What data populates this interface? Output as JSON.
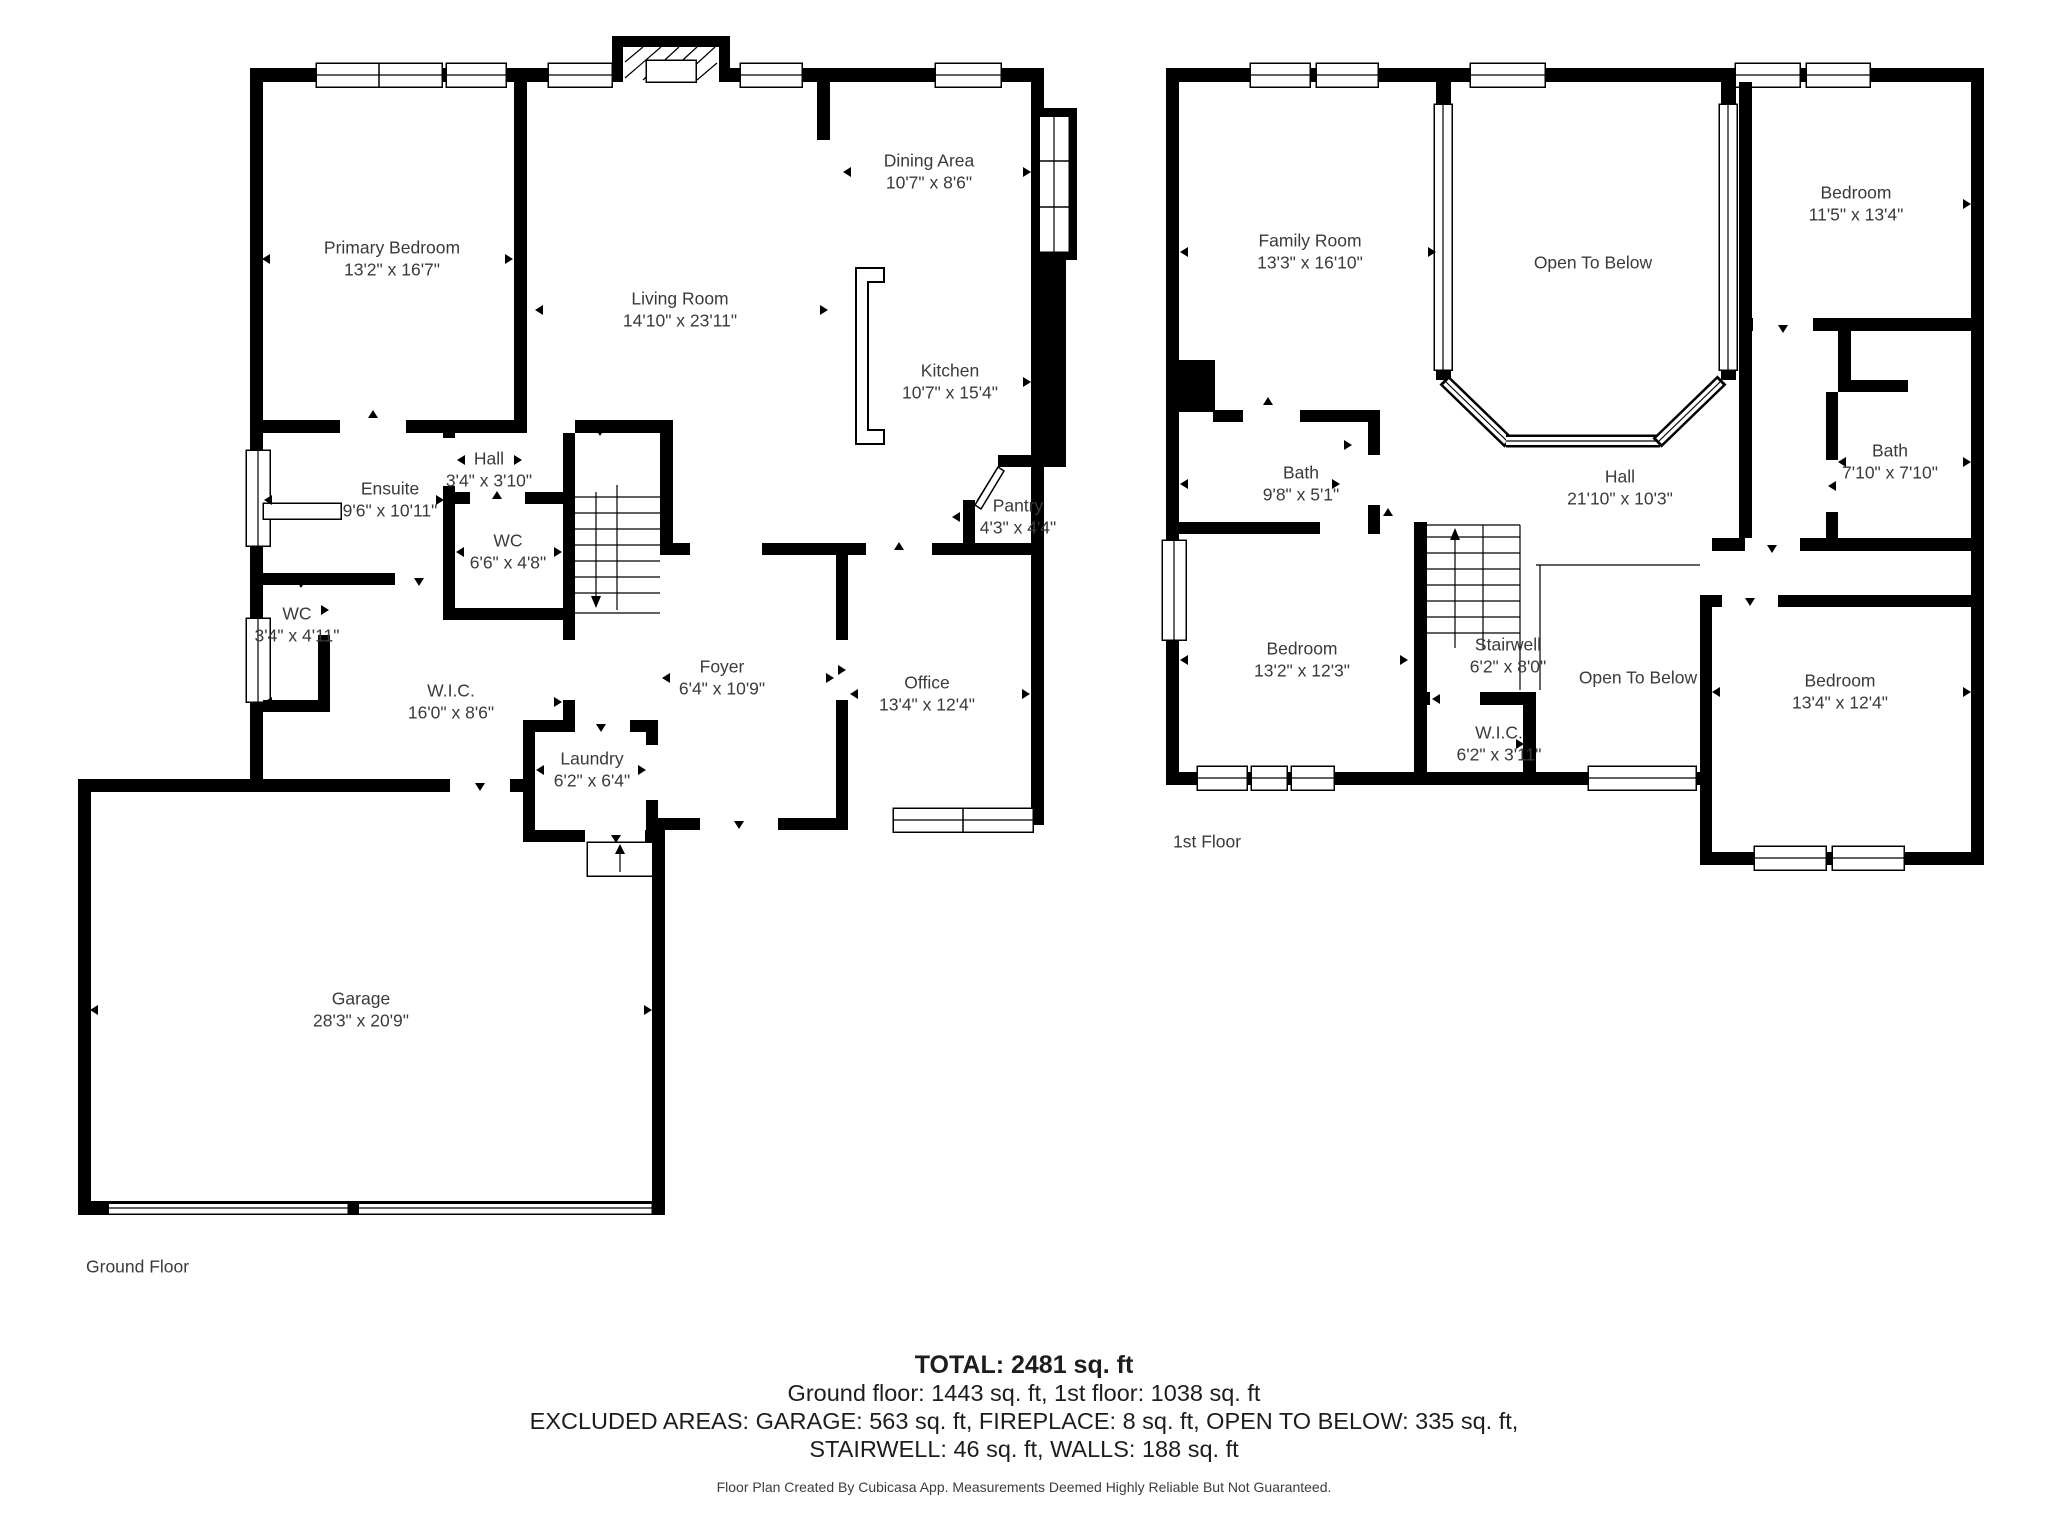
{
  "ground": {
    "label": "Ground Floor",
    "rooms": [
      {
        "name": "Primary Bedroom",
        "dims": "13'2\" x 16'7\""
      },
      {
        "name": "Living Room",
        "dims": "14'10\" x 23'11\""
      },
      {
        "name": "Dining Area",
        "dims": "10'7\" x 8'6\""
      },
      {
        "name": "Kitchen",
        "dims": "10'7\" x 15'4\""
      },
      {
        "name": "Hall",
        "dims": "3'4\" x 3'10\""
      },
      {
        "name": "Ensuite",
        "dims": "9'6\" x 10'11\""
      },
      {
        "name": "WC",
        "dims": "6'6\" x 4'8\""
      },
      {
        "name": "WC",
        "dims": "3'4\" x 4'11\""
      },
      {
        "name": "W.I.C.",
        "dims": "16'0\" x 8'6\""
      },
      {
        "name": "Foyer",
        "dims": "6'4\" x 10'9\""
      },
      {
        "name": "Office",
        "dims": "13'4\" x 12'4\""
      },
      {
        "name": "Pantry",
        "dims": "4'3\" x 4'4\""
      },
      {
        "name": "Laundry",
        "dims": "6'2\" x 6'4\""
      },
      {
        "name": "Garage",
        "dims": "28'3\" x 20'9\""
      }
    ]
  },
  "first": {
    "label": "1st Floor",
    "rooms": [
      {
        "name": "Family Room",
        "dims": "13'3\" x 16'10\""
      },
      {
        "name": "Open To Below",
        "dims": ""
      },
      {
        "name": "Bedroom",
        "dims": "11'5\" x 13'4\""
      },
      {
        "name": "Bath",
        "dims": "9'8\" x 5'1\""
      },
      {
        "name": "Hall",
        "dims": "21'10\" x 10'3\""
      },
      {
        "name": "Bath",
        "dims": "7'10\" x 7'10\""
      },
      {
        "name": "Bedroom",
        "dims": "13'2\" x 12'3\""
      },
      {
        "name": "Stairwell",
        "dims": "6'2\" x 8'0\""
      },
      {
        "name": "Open To Below",
        "dims": ""
      },
      {
        "name": "W.I.C.",
        "dims": "6'2\" x 3'11\""
      },
      {
        "name": "Bedroom",
        "dims": "13'4\" x 12'4\""
      }
    ]
  },
  "summary": {
    "total": "TOTAL: 2481 sq. ft",
    "floors": "Ground floor: 1443 sq. ft, 1st floor: 1038 sq. ft",
    "excluded1": "EXCLUDED AREAS: GARAGE: 563 sq. ft, FIREPLACE: 8 sq. ft, OPEN TO BELOW: 335 sq. ft,",
    "excluded2": "STAIRWELL: 46 sq. ft, WALLS: 188 sq. ft",
    "footer": "Floor Plan Created By Cubicasa App. Measurements Deemed Highly Reliable But Not Guaranteed."
  }
}
